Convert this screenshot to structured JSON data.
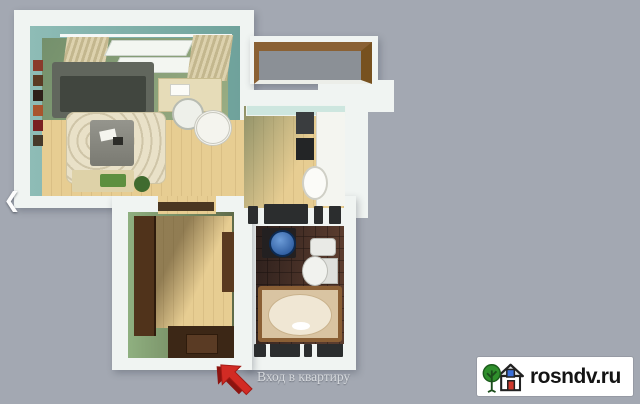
{
  "page": {
    "background_color": "#a3a8b2",
    "content": "3D top-down render of a one-room apartment floor plan"
  },
  "carousel": {
    "prev_icon": "❮"
  },
  "entrance": {
    "label": "Вход в квартиру",
    "text_color": "#d6d9dd",
    "arrow_color": "#d22b24",
    "arrow_shadow_color": "#8d1410",
    "arrow_direction": "up-left"
  },
  "watermark": {
    "site": "rosndv.ru",
    "background": "#ffffff",
    "text_color": "#141414",
    "logo": {
      "tree_color": "#2f8f2c",
      "outline_color": "#222222",
      "window_color": "#3a6fd8",
      "door_color": "#d03a2e"
    }
  },
  "floorplan": {
    "rooms": [
      "living-room",
      "kitchen",
      "balcony",
      "hallway",
      "bathroom"
    ],
    "features": [
      "windows-with-curtains",
      "sofa",
      "rug",
      "coffee-table",
      "desk",
      "office-chair",
      "round-table",
      "wall-frames",
      "bench",
      "kitchen-counter",
      "fridge",
      "stove",
      "kitchen-sink",
      "balcony-railing",
      "washing-machine",
      "bathroom-sink",
      "toilet",
      "bathtub",
      "wardrobe-door",
      "entrance-area"
    ],
    "colors": {
      "walls_exterior": "#f0f4f2",
      "living_wall_teal": "#84b6b0",
      "hallway_wall_green": "#7d9a6b",
      "floor_wood": "#e7cd92",
      "balcony_rail_brown": "#8a6134",
      "balcony_floor_gray": "#8b9096",
      "bathroom_tile_dark": "#3a2a26",
      "sofa_gray": "#555a52",
      "washer_lid_blue": "#2d62ac"
    }
  }
}
